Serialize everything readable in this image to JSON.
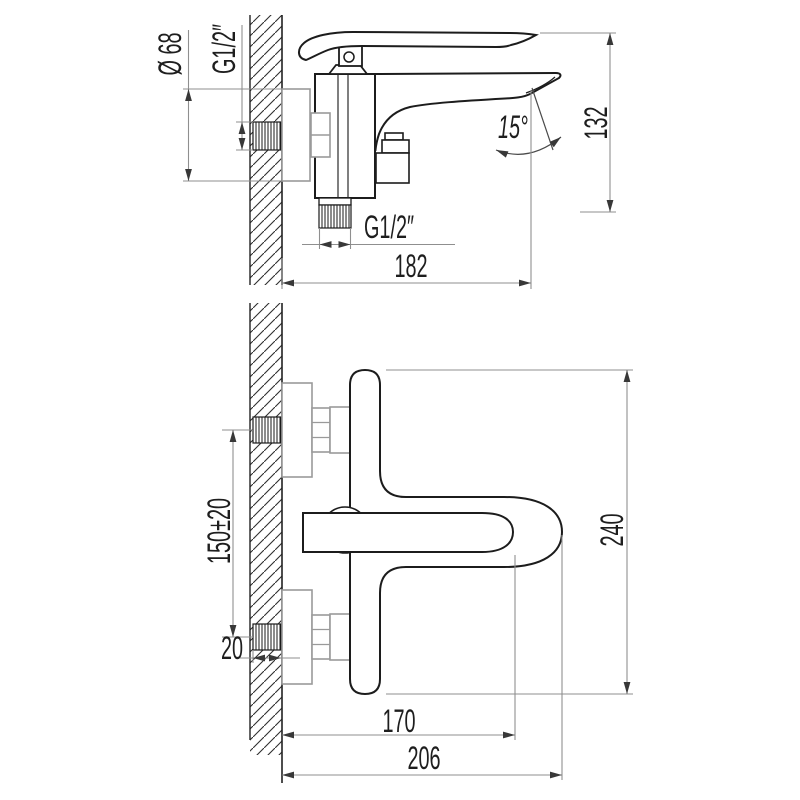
{
  "side_view": {
    "labels": {
      "flange_diameter": "Ø 68",
      "wall_thread": "G1/2″",
      "spout_angle": "15°",
      "height": "132",
      "spout_reach": "182",
      "outlet_thread": "G1/2″"
    }
  },
  "front_view": {
    "labels": {
      "inlet_centers": "150±20",
      "thread_projection": "20",
      "overall_height": "240",
      "handle_reach": "170",
      "overall_reach": "206"
    }
  }
}
